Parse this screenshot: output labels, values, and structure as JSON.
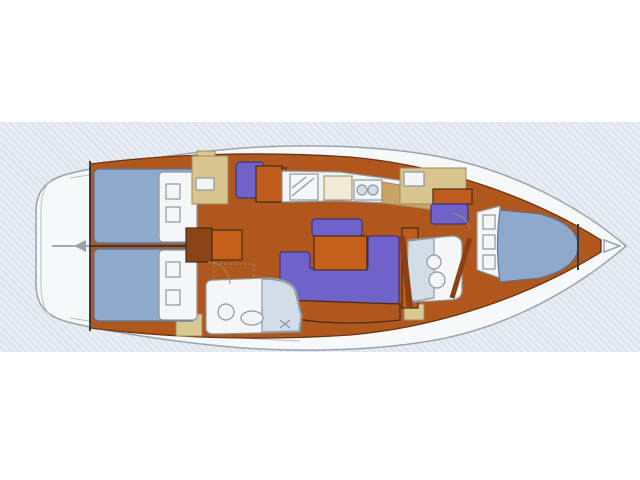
{
  "figure": {
    "type": "sailboat-interior-deck-plan",
    "orientation": "bow-right",
    "areas": [
      "stern-platform",
      "aft-cabin-upper",
      "aft-cabin-lower",
      "companionway-steps",
      "aft-head",
      "nav-station",
      "galley",
      "salon-settee",
      "salon-table",
      "forward-head",
      "forward-cabin",
      "v-berth",
      "anchor-locker"
    ]
  },
  "colors": {
    "background": "#ffffff",
    "band_base": "#e9edf3",
    "band_stripe": "#dde3eb",
    "hull_white": "#f7f8fa",
    "hull_outline": "#9aa3ad",
    "lining_orange": "#b0571d",
    "floor_tan": "#c9a465",
    "beige_cabinet": "#d8c48e",
    "seat_beige": "#d9c892",
    "counter_white": "#f2f4f6",
    "fixture_white": "#f4f6f8",
    "fixture_blue": "#d2dde8",
    "bed_blue": "#8fa9cd",
    "pillow_white": "#f4f6f8",
    "settee_purple": "#6f63c9",
    "table_orange": "#c65f1c",
    "cabinet_orange": "#bf5c1d",
    "wood_dark": "#8a4517",
    "step_brown": "#6e3210",
    "stove_cream": "#f1ead6",
    "burner_dark": "#473a26",
    "arrow_gray": "#9aa0a8"
  }
}
